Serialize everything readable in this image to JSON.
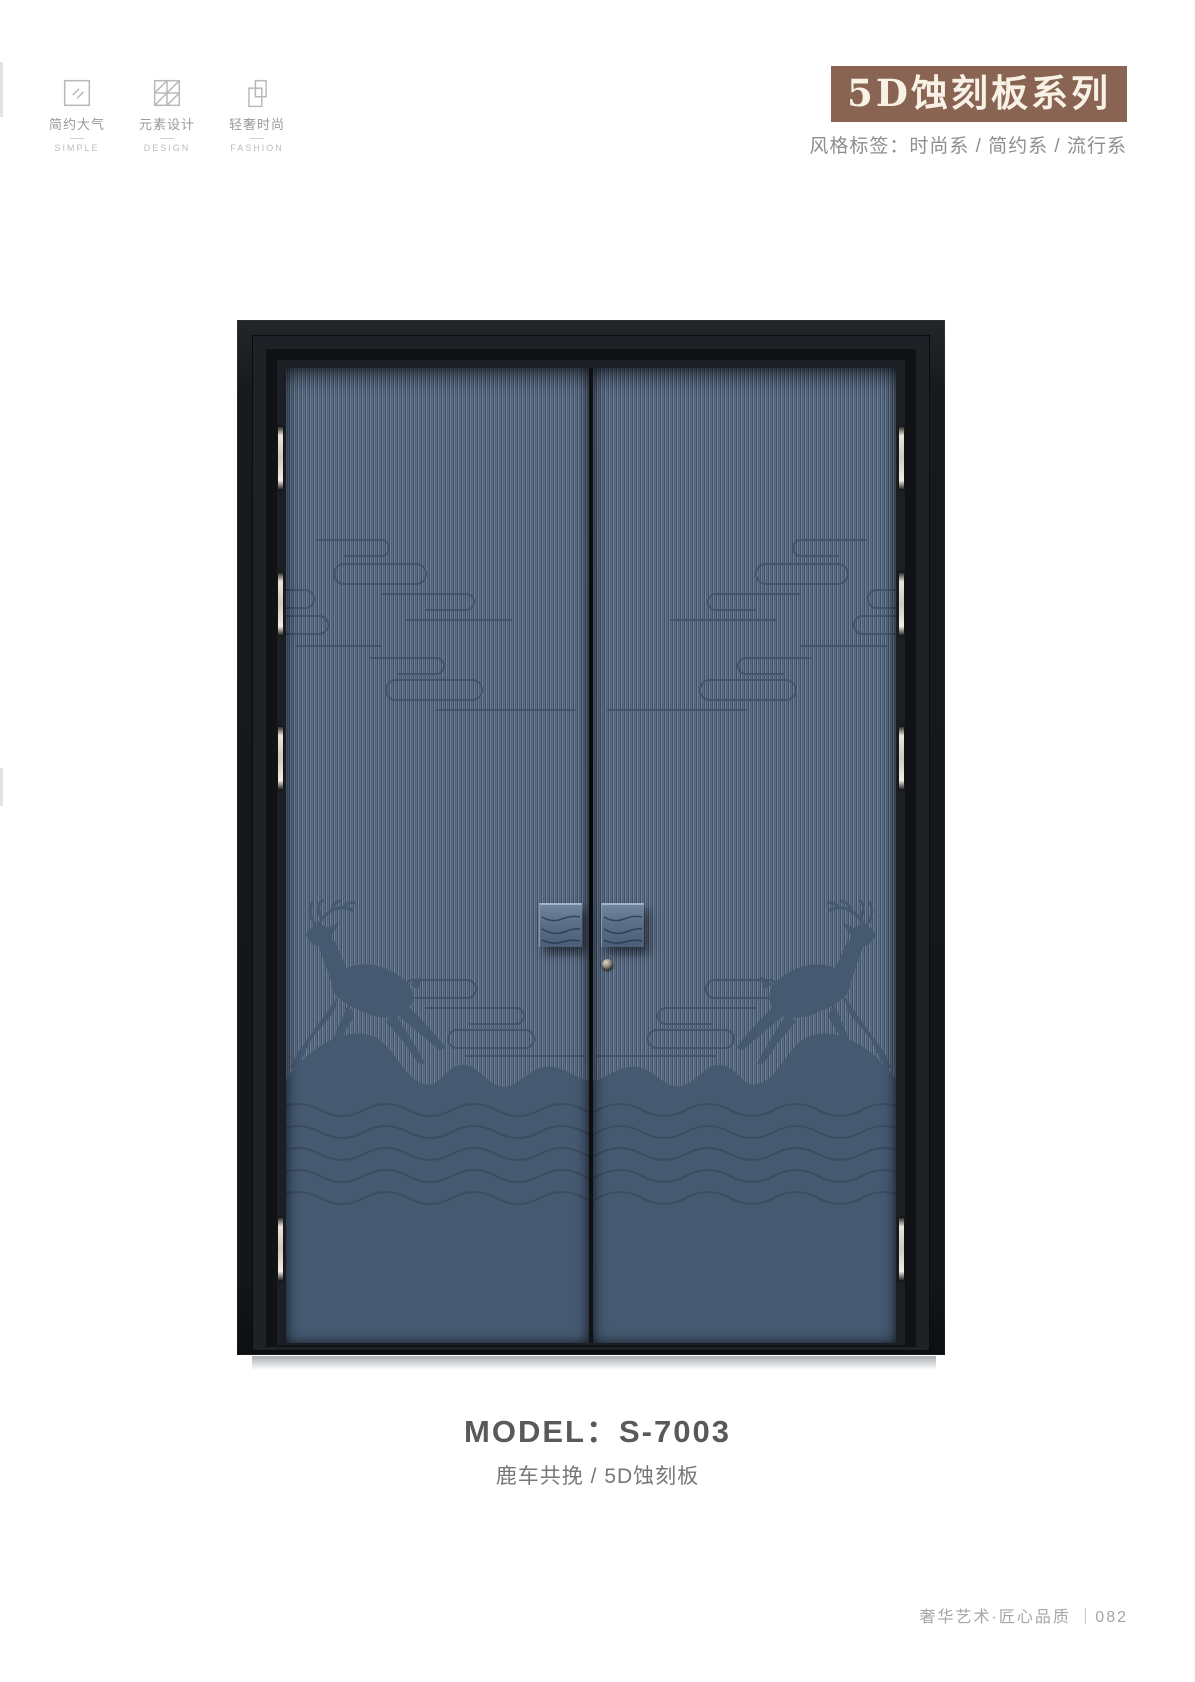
{
  "header": {
    "features": [
      {
        "zh": "简约大气",
        "en": "SIMPLE",
        "icon": "glass-pane-icon"
      },
      {
        "zh": "元素设计",
        "en": "DESIGN",
        "icon": "panel-grid-icon"
      },
      {
        "zh": "轻奢时尚",
        "en": "FASHION",
        "icon": "door-overlap-icon"
      }
    ],
    "series_title": "5D蚀刻板系列",
    "style_tags": "风格标签：时尚系 / 简约系 / 流行系"
  },
  "door": {
    "motifs": [
      "leaping-deer",
      "auspicious-clouds",
      "mountain-waves"
    ],
    "colors": {
      "frame": "#17191d",
      "panel_base": "#566780",
      "panel_stripe_light": "#72839a",
      "panel_stripe_dark": "#3f5066",
      "silhouette": "#455a71",
      "handle": "#5f738d",
      "hinge": "#d9d4c8",
      "banner_bg": "#8a6453",
      "banner_text": "#f7f1e6"
    }
  },
  "product": {
    "model": "MODEL：S-7003",
    "subtitle": "鹿车共挽 / 5D蚀刻板"
  },
  "footer": {
    "text": "奢华艺术·匠心品质 ｜082"
  }
}
